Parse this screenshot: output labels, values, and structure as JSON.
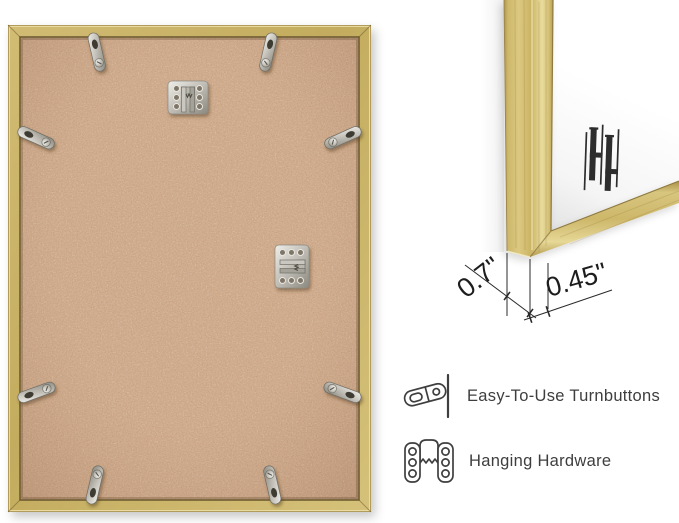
{
  "back_view": {
    "name": "frame back with mounting hardware",
    "frame_color": "#c8b166",
    "backing_color": "#cda687",
    "turnbutton_count": 8,
    "sawtooth_hanger_count": 2
  },
  "corner_view": {
    "name": "frame corner close-up",
    "frame_color": "#d6c07c",
    "mat_color": "#ffffff",
    "logo": "brand-monogram"
  },
  "dimensions": {
    "frame_depth": "0.7\"",
    "frame_face_width": "0.45\""
  },
  "features": [
    {
      "icon": "turnbutton-icon",
      "label": "Easy-To-Use Turnbuttons"
    },
    {
      "icon": "sawtooth-hanger-icon",
      "label": "Hanging Hardware"
    }
  ],
  "colors": {
    "annotation_line": "#2b2b2b",
    "dimension_text": "#1d1d1d",
    "feature_text": "#3e3e3e",
    "icon_outline": "#3f3f3f"
  }
}
